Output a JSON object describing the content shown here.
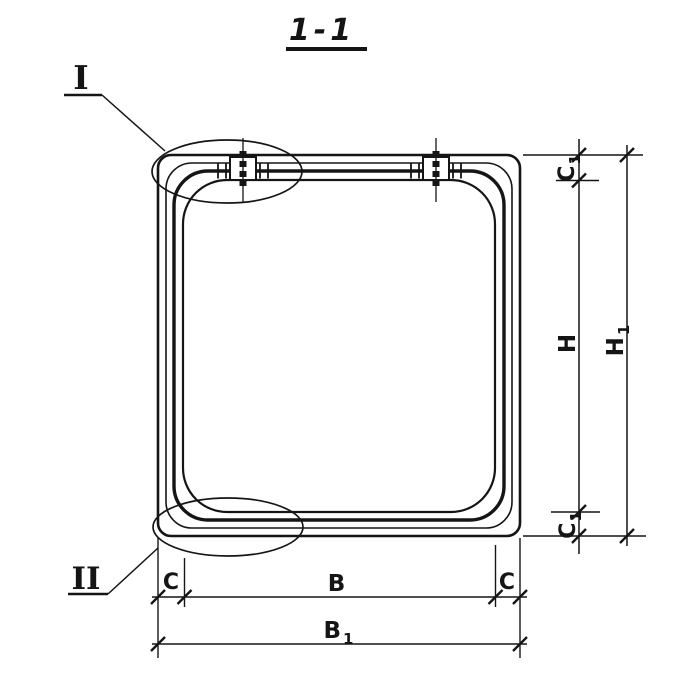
{
  "drawing": {
    "title": "1-1",
    "markers": {
      "detail_1": "I",
      "detail_2": "II"
    },
    "dims": {
      "c_left": "C",
      "b": "B",
      "c_right": "C",
      "b1": {
        "base": "B",
        "sub": "1"
      },
      "c1_top": {
        "base": "C",
        "sub": "1"
      },
      "h": "H",
      "h1": {
        "base": "H",
        "sub": "1"
      },
      "c1_bottom": {
        "base": "C",
        "sub": "1"
      }
    },
    "colors": {
      "ink": "#151515",
      "paper": "#ffffff"
    }
  }
}
